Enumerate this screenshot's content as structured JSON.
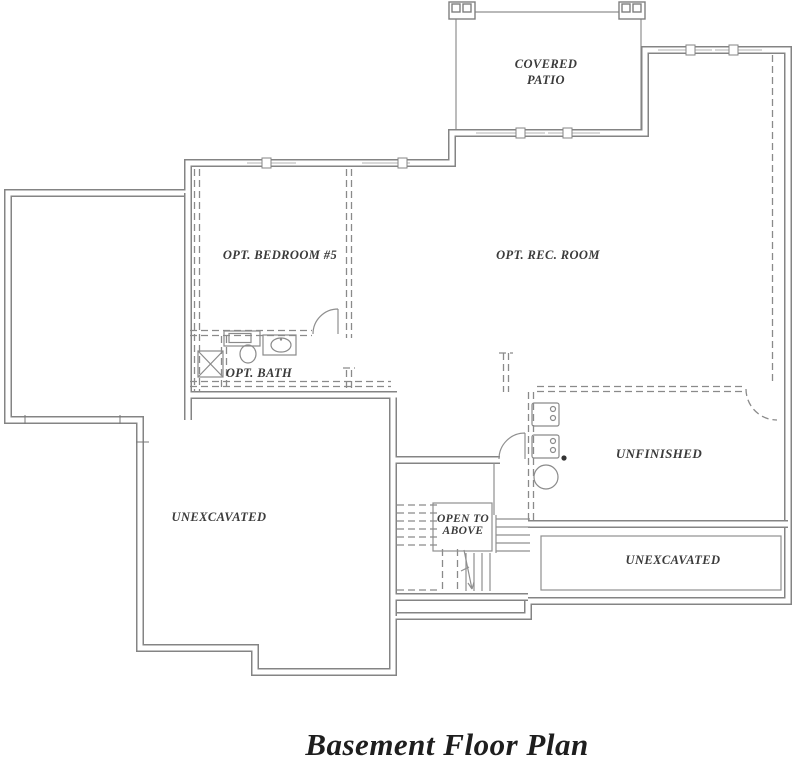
{
  "drawing": {
    "title": "Basement Floor Plan",
    "labels": {
      "covered_patio_1": "COVERED",
      "covered_patio_2": "PATIO",
      "opt_bedroom": "OPT. BEDROOM #5",
      "opt_rec_room": "OPT. REC. ROOM",
      "opt_bath": "OPT. BATH",
      "unexcavated_left": "UNEXCAVATED",
      "unfinished": "UNFINISHED",
      "open_to_above_1": "OPEN TO",
      "open_to_above_2": "ABOVE",
      "unexcavated_right": "UNEXCAVATED"
    },
    "colors": {
      "wall": "#848484",
      "thin_line": "#8f8f8f",
      "text": "#3b3b3b",
      "background": "#ffffff"
    }
  }
}
